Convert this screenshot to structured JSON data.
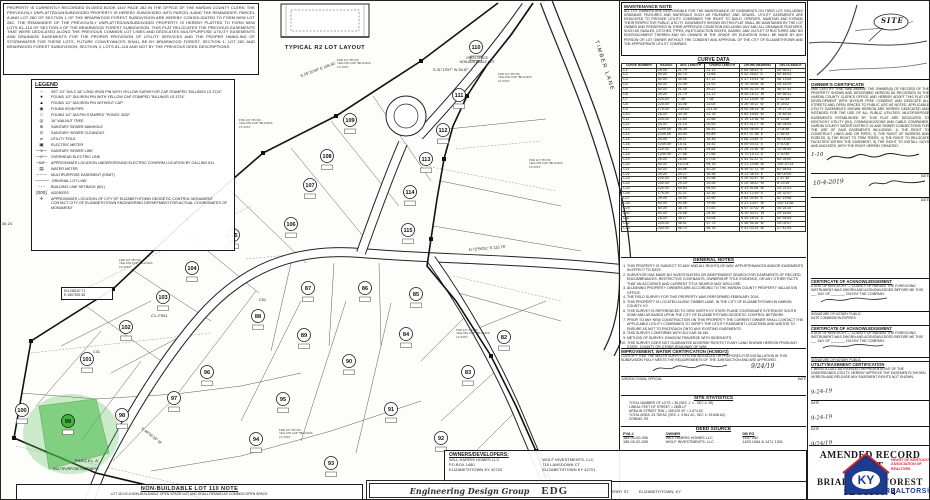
{
  "deed_note": {
    "text": "PROPERTY IS CURRENTLY RECORDED IN DEED BOOK 1447 PAGE 282 IN THE OFFICE OF THE HARDIN COUNTY CLERK. THE PREVIOUSLY UNPLATTED/UNSUBDIVIDED PROPERTY IS HEREBY SUBDIVIDED INTO PARCEL A AND THE REMAINDER. PARCEL A AND LOT 28C OF SECTION 1 OF THE BRIARWOOD FOREST SUBDIVISION ARE HEREBY CONSOLIDATED TO FORM NEW LOT 28C. THE REMAINDER OF THE PREVIOUSLY UNPLATTED/UNSUBDIVIDED PROPERTY IS HEREBY PLATTED TO FORM NEW LOTS 81–115 OF SECTION 4 OF THE BRIARWOOD FOREST SUBDIVISION. THIS PLAT RELOCATES THE PREVIOUS EASEMENTS THAT WERE DEDICATED ALONG THE PREVIOUS COMMON LOT LINES AND DEDICATES MULTIPURPOSE UTILITY EASEMENTS AND DRAINAGE EASEMENTS FOR THE PROPER PROVISION OF UTILITY SERVICES AND THE PROPER HANDLING OF STORMWATER FOR THESE LOTS. FUTURE CONVEYANCES SHALL BE BY BRIARWOOD FOREST, SECTION 1, LOT 28C AND BRIARWOOD FOREST SUBDIVISION, SECTION 4, LOTS 81–115 AND NOT BY THE PREVIOUS DEED DESCRIPTIONS."
  },
  "legend": {
    "title": "LEGEND",
    "items": [
      {
        "sym": "○",
        "label": "SET 1/2″ DIA X 18″ LONG IRON PIN WITH YELLOW SURVEYOR CAP STAMPED \"BILLINGS LS 3724\""
      },
      {
        "sym": "●",
        "label": "FOUND 1/2″ DIA IRON PIN WITH YELLOW CAP STAMPED \"BILLINGS LS 3724\""
      },
      {
        "sym": "▲",
        "label": "FOUND 1/2″ DIA IRON PIN WITHOUT CAP"
      },
      {
        "sym": "◉",
        "label": "FOUND IRON PIPE"
      },
      {
        "sym": "□",
        "label": "FOUND 1/2″ DIA PIN STAMPED \"PONCE 3032\""
      },
      {
        "sym": "◎",
        "label": "16″ WALNUT TREE"
      },
      {
        "sym": "⊜",
        "label": "SANITARY SEWER MANHOLE"
      },
      {
        "sym": "⊙",
        "label": "SANITARY SEWER CLEANOUT"
      },
      {
        "sym": "⌀",
        "label": "UTILITY POLE"
      },
      {
        "sym": "▣",
        "label": "ELECTRIC METER"
      },
      {
        "sym": "—s—",
        "label": "SANITARY SEWER LINE"
      },
      {
        "sym": "—e—",
        "label": "OVERHEAD ELECTRIC LINE"
      },
      {
        "sym": "–ue–",
        "label": "APPROXIMATE LOCATION UNDERGROUND ELECTRIC CONFIRM LOCATION BY CALLING 811"
      },
      {
        "sym": "▤",
        "label": "WATER METER"
      },
      {
        "sym": "– – –",
        "label": "MULTIPURPOSE EASEMENT (ESMT)"
      },
      {
        "sym": "———",
        "label": "ORIGINAL LOT LINE"
      },
      {
        "sym": "- - -",
        "label": "BUILDING LINE SETBACK (B/L)"
      },
      {
        "sym": "[000]",
        "label": "ADDRESS"
      },
      {
        "sym": "✛",
        "label": "APPROXIMATE LOCATION OF CITY OF ELIZABETHTOWN GEODETIC CONTROL MONUMENT.  CONTACT CITY OF ELIZABETHTOWN ENGINEERING DEPARTMENT FOR ACTUAL COORDINATES OF MONUMENT"
      }
    ]
  },
  "typical_lot": {
    "caption": "TYPICAL R2 LOT LAYOUT"
  },
  "maintenance_note": {
    "title": "MAINTENANCE NOTE",
    "text": "ALL LOT OWNERS ARE RESPONSIBLE FOR THE MAINTENANCE OF EASEMENTS ON THEIR LOT, INCLUDING DRAINAGE FEATURES AND MATERIALS SUCH AS PAVEMENT AND GRAVEL. UTILITY EASEMENTS ARE DEDICATED TO PROVIDE UTILITY COMPANIES THE RIGHT TO BUILD, OPERATE, MAINTAIN AND EXPAND THEIR RESPECTIVE PUBLIC UTILITY. EASEMENTS SHOWN ON THIS PLAT SHALL BE MAINTAINED BY THE LOT OWNER AND PRESERVED IN THEIR APPROVED CONDITION INCLUDING ANY AND ALL DRAINAGE FEATURES, SUCH AS SWALES, DITCHES, PIPES, INLET/JUNCTION BOXES, BASINS, AND OUTLET STRUCTURES AND NO ENCROACHMENT THEREIN AND NO CHANGE IN THE GRADE OR ELEVATION SHALL BE MADE BY ANY PERSON OR LOT OWNER WITHOUT THE CONSENT AND APPROVAL OF THE CITY OF ELIZABETHTOWN AND THE APPROPRIATE UTILITY COMPANY."
  },
  "curve_table": {
    "title": "CURVE DATA",
    "headers": [
      "CURVE NUMBER",
      "RADIUS",
      "ARC LENGTH",
      "CHORD LENGTH",
      "CHORD BEARING",
      "DELTA ANGLE"
    ],
    "rows": [
      [
        "C1",
        "25.00'",
        "21.79'",
        "21.11'",
        "S 85°58'43\" E",
        "49°56'41\""
      ],
      [
        "C2",
        "50.00'",
        "82.70'",
        "73.65'",
        "S 42°26'52\" E",
        "94°46'03\""
      ],
      [
        "C3",
        "50.00'",
        "49.06'",
        "47.11'",
        "S 37°19'41\" W",
        "56°13'05\""
      ],
      [
        "C4",
        "50.00'",
        "22.09'",
        "21.91'",
        "S 78°05'28\" W",
        "25°18'29\""
      ],
      [
        "C5",
        "50.00'",
        "51.45'",
        "49.22'",
        "N 59°42'25\" W",
        "58°57'44\""
      ],
      [
        "C6",
        "25.00'",
        "21.79'",
        "21.11'",
        "N 55°16'12\" W",
        "49°56'41\""
      ],
      [
        "C7",
        "225.00'",
        "7.38'",
        "7.38'",
        "S 31°14'05\" W",
        "1°52'45\""
      ],
      [
        "C8",
        "225.00'",
        "33.06'",
        "33.03'",
        "S 26°05'11\" W",
        "8°25'02\""
      ],
      [
        "C9",
        "175.00'",
        "239.63'",
        "221.30'",
        "N 60°06'14\" W",
        "78°27'13\""
      ],
      [
        "C10",
        "25.00'",
        "34.39'",
        "31.76'",
        "S 60°16'55\" W",
        "78°48'34\""
      ],
      [
        "C11",
        "225.00'",
        "12.69'",
        "12.68'",
        "S 19°14'18\" W",
        "3°13'46\""
      ],
      [
        "C12",
        "25.00'",
        "21.15'",
        "20.53'",
        "S 41°51'27\" W",
        "48°28'05\""
      ],
      [
        "C13",
        "1049.59'",
        "56.44'",
        "56.43'",
        "N 64°06'55\" E",
        "3°04'48\""
      ],
      [
        "C14",
        "1049.59'",
        "53.90'",
        "53.89'",
        "N 67°07'36\" E",
        "2°56'34\""
      ],
      [
        "C15",
        "25.00'",
        "39.27'",
        "35.36'",
        "S 66°23'45\" E",
        "90°00'00\""
      ],
      [
        "C16",
        "1049.59'",
        "15.41'",
        "15.41'",
        "N 69°04'31\" E",
        "0°50'28\""
      ],
      [
        "C17",
        "225.00'",
        "54.78'",
        "54.65'",
        "S 28°21'46\" W",
        "13°56'59\""
      ],
      [
        "C18",
        "1049.59'",
        "27.68'",
        "27.68'",
        "N 70°15'13\" E",
        "1°30'39\""
      ],
      [
        "C19",
        "25.00'",
        "28.55'",
        "27.05'",
        "S 53°41'22\" E",
        "65°26'00\""
      ],
      [
        "C20",
        "50.00'",
        "113.04'",
        "94.76'",
        "S 21°23'08\" W",
        "104°20'13\""
      ],
      [
        "C21",
        "50.00'",
        "54.96'",
        "52.26'",
        "N 49°37'11\" W",
        "62°58'04\""
      ],
      [
        "C22",
        "25.00'",
        "39.27'",
        "35.36'",
        "N 23°36'15\" E",
        "90°00'00\""
      ],
      [
        "C23",
        "225.00'",
        "10.98'",
        "10.98'",
        "S 20°02'47\" W",
        "2°47'30\""
      ],
      [
        "C24",
        "200.00'",
        "29.29'",
        "29.26'",
        "S 25°38'22\" W",
        "8°23'15\""
      ],
      [
        "C25",
        "225.00'",
        "95.64'",
        "94.93'",
        "S 33°51'06\" W",
        "24°21'31\""
      ],
      [
        "C26",
        "175.00'",
        "32.21'",
        "32.16'",
        "N 41°12'49\" E",
        "10°32'47\""
      ],
      [
        "C27",
        "25.00'",
        "35.92'",
        "32.90'",
        "S 64°09'30\" E",
        "82°19'48\""
      ],
      [
        "C28",
        "50.00'",
        "90.96'",
        "79.95'",
        "S 31°13'57\" W",
        "104°14'46\""
      ],
      [
        "C29",
        "50.00'",
        "38.75'",
        "37.81'",
        "N 67°37'02\" W",
        "44°24'10\""
      ],
      [
        "C30",
        "50.00'",
        "25.58'",
        "25.30'",
        "N 30°44'37\" W",
        "29°18'40\""
      ],
      [
        "C31",
        "25.00'",
        "36.17'",
        "33.08'",
        "N 55°28'31\" E",
        "82°54'04\""
      ],
      [
        "C32",
        "225.00'",
        "98.51'",
        "97.73'",
        "S 48°06'18\" W",
        "25°04'57\""
      ],
      [
        "C33",
        "200.00'",
        "96.70'",
        "95.76'",
        "S 41°02'33\" W",
        "27°42'05\""
      ]
    ]
  },
  "general_notes": {
    "title": "GENERAL NOTES",
    "items": [
      "THIS PROPERTY IS SUBJECT TO ANY AND ALL RIGHTS-OF-WAY, APPURTENANCES AND/OR EASEMENTS IN EFFECT TO DATE.",
      "SURVEYOR HAS MADE NO INVESTIGATION OR INDEPENDENT SEARCH FOR EASEMENTS OF RECORD, ENCUMBRANCES, RESTRICTIVE COVENANTS, OWNERSHIP TITLE EVIDENCE, OR ANY OTHER FACTS THAT AN ACCURATE AND CURRENT TITLE SEARCH MAY DISCLOSE.",
      "ADJOINING PROPERTY OWNERS ARE ACCORDING TO THE HARDIN COUNTY PROPERTY VALUATION OFFICE.",
      "THE FIELD SURVEY FOR THIS PROPERTY WAS PERFORMED FEBRUARY 2019.",
      "THIS PROPERTY IS LOCATED ALONG TIMBER LANE, IN THE CITY OF ELIZABETHTOWN IN HARDIN COUNTY, KY.",
      "THIS SURVEY IS REFERENCED TO GRID NORTH KY STATE PLANE COORDINATE SYSTEM BY SOUTH ZONE AND AS BASED UPON THE CITY OF ELIZABETHTOWN GEODETIC CONTROL NETWORK.",
      "PRIOR TO ANY NEW CONSTRUCTION ON THIS PROPERTY THE CURRENT OWNER SHALL CONTACT THE APPLICABLE UTILITY COMPANIES TO VERIFY THE UTILITY EASEMENT LOCATIONS AND WIDTHS TO ENSURE AS NOT TO ENCROACH ONTO ANY EXISTING EASEMENTS.",
      "THIS SURVEY CONFORMS WITH 201 KAR 18:150.",
      "METHOD OF SURVEY:  RANDOM TRAVERSE WITH SIDESHOTS.",
      "THIS SURVEY DOES NOT GUARANTEE ADVERSE RIGHTS TO ANY LAND SHOWN HEREON FROM ANY STATE, COUNTY OR OTHER ROADWAY OF WAY.",
      "THE RECORD SOURCE OF RIGHT OF WAY OF TIMBER LANE IS RECORD PLAT BRIARWOOD FOREST SECTION 2 IN PLAT CABINET 1 SHEET 4052 IN THE OFFICE OF THE HARDIN COUNTY CLERK."
    ]
  },
  "improvement_cert": {
    "title": "IMPROVEMENT, WATER CERTIFICATION (HCWD#2)",
    "text": "I CERTIFY THAT THE WATER SUPPLY SYSTEM INSTALLED OR PROPOSED FOR INSTALLATION IN THIS SUBDIVISION FULLY MEETS THE REQUIREMENTS OF THE JURISDICTION AND ARE APPROVED.",
    "official_label": "JURISDICTIONAL OFFICIAL",
    "date_label": "DATE",
    "date": "9/24/19"
  },
  "site_statistics": {
    "title": "SITE STATISTICS",
    "lines": [
      "TOTAL NUMBER OF LOTS = 36 (SEC 1: 1 , SEC 4: 35)",
      "LINEAL FEET OF STREET = 2655 LF",
      "AREA IN STREET R/W = 155,675 SF = 3.574 AC",
      "TOTAL AREA: 23.789 AC (SEC 1: 3.941 AC, SEC 4: 19.848 AC)",
      "ZONING:  R2"
    ]
  },
  "deed_source": {
    "title": "DEED SOURCE",
    "headers": [
      "PVA #",
      "OWNER",
      "DB   PG"
    ],
    "rows": [
      [
        "185-00-00-036",
        "WILL HARRIS HOMES LLC",
        "1447   282"
      ],
      [
        "185-00-02-039",
        "WOLF INVESTMENTS, LLC",
        "1453  1064 & 1471  1331"
      ]
    ]
  },
  "owners": {
    "title": "OWNERS/DEVELOPERS:",
    "col1": [
      "WILL HARRIS HOMES LLC",
      "PO BOX 1480",
      "ELIZABETHTOWN KY 42702"
    ],
    "col2": [
      "WOLF INVESTMENTS, LLC",
      "710 LANSDOWN CT",
      "ELIZABETHTOWN KY 42701"
    ]
  },
  "engineer": {
    "title": "ENGINEER/SURVEYOR:",
    "lines": [
      "ENGINEERING DESIGN GROUP, INC",
      "305 SOUTH MULBERRY ST",
      "ELIZABETHTOWN, KY"
    ]
  },
  "edg_stamp": {
    "line1": "Engineering Design Group",
    "line2": "EDG"
  },
  "non_buildable": {
    "title": "NON-BUILDABLE LOT 110 NOTE",
    "text": "LOT 110 IS A NON-BUILDABLE OPEN SPACE LOT AND SHALL REMAIN AS COMMON OPEN SPACE."
  },
  "owner_cert": {
    "title": "OWNER'S CERTIFICATE",
    "text": "I/WE CERTIFY THAT I/WE AM/ARE THE OWNER(S) OF RECORD OF THE PROPERTY SHOWN AND DESCRIBED HEREON AS RECORDED IN THE HARDIN COUNTY CLERK'S OFFICE AND HEREBY ADOPT THIS PLAT OF DEVELOPMENT WITH MY/OUR FREE CONSENT AND DEDICATE ALL STREETS AND OPEN SPACES TO PUBLIC USE AS NOTED. APPLICABLE UTILITY EASEMENTS SHOWN HEREON ARE HEREBY DEDICATED AND INTENDED FOR THE USE OF ALL PUBLIC UTILITIES. MULTIPURPOSE EASEMENTS ESTABLISHED BY THIS PLAT ARE DEDICATED TO KENTUCKY UTILITY (KU), COMMUNICATIONS AND CABLE COMPANIES, HARDIN COUNTY WATER DISTRICT #2 AND SEWER CONNECTIONS FOR THE USE OF SAID EASEMENTS INCLUDING: 1) THE RIGHT TO CONSTRUCT LINES AND OR PIPES, 2) THE RIGHT OF INGRESS AND EGRESS, 3) THE RIGHT TO TRIM TREES, 4) THE RIGHT TO RELOCATE FACILITIES WITHIN THE EASEMENT, 5) THE RIGHT TO INSTALL GUYS AND ANCHORS, WITH THE RIGHT HEREBY GRANTED.",
    "date1": "1-10",
    "date2": "10-4-2019",
    "date_label": "DATE"
  },
  "ack_certs": {
    "title": "CERTIFICATE OF ACKNOWLEDGEMENT",
    "body": "STATE OF KENTUCKY — COUNTY OF HARDIN. THE FOREGOING INSTRUMENT WAS SWORN AND ACKNOWLEDGED BEFORE ME THIS ___ DAY OF _______, 2019 BY THE COMPANY.",
    "notary_label": "SIGNATURE OF NOTARY PUBLIC",
    "expires_label": "DATE COMMISSION EXPIRES"
  },
  "utility_cert": {
    "title": "UTILITY/EASEMENT CERTIFICATION",
    "text": "I, BEING A DULY AUTHORIZED REPRESENTATIVE OF THE UNDERSIGNED UTILITY, HEREBY APPROVE THE EASEMENTS SHOWN HEREON AND RELEASE ANY EASEMENT RIGHTS NOT SHOWN.",
    "date_label": "DATE",
    "dates": [
      "9-24-19",
      "9-24-19",
      "9/24/19",
      "12-9-2019"
    ]
  },
  "title_block": {
    "line1": "AMENDED RECORD PLAT",
    "line2": "OF",
    "line3": "BRIARWOOD FOREST",
    "line4": "SECTION 4"
  },
  "ky_logo": {
    "text": "KY",
    "tagline1": "HEART OF KENTUCKY",
    "tagline2": "ASSOCIATION OF",
    "tagline3": "REALTORS",
    "realtors": "REALTORS®",
    "blue": "#1d3c8f",
    "red": "#d22730"
  },
  "vicinity": {
    "site_label": "SITE"
  },
  "plat": {
    "road_label": "TIMBER LANE",
    "coord_line1": "N:2138167.71",
    "coord_line2": "E:1507592.36",
    "parcel_label": "PARCEL A",
    "easement_label": "MULTIPURPOSE EASEMENT",
    "open_space_line1": "OPEN SPACE",
    "open_space_line2": "NON-BUILDABLE LOT",
    "c_label": "C1–F901",
    "edge_dim": "35.24",
    "pin_note": "FND 1/2″ PIN W/ YELLOW CAP \"BILLINGS LS 3724\"",
    "pin_note_positions": [
      [
        336,
        58
      ],
      [
        238,
        118
      ],
      [
        118,
        258
      ],
      [
        497,
        72
      ],
      [
        528,
        158
      ],
      [
        455,
        328
      ],
      [
        278,
        428
      ],
      [
        155,
        198
      ]
    ],
    "bearings": [
      {
        "t": "S 25°10'30\" E  155.40'",
        "x": 300,
        "y": 76,
        "r": -20
      },
      {
        "t": "S 31°13'57\" W  30.87'",
        "x": 432,
        "y": 70,
        "r": 0
      },
      {
        "t": "N 72°56'51\" E  115.78'",
        "x": 468,
        "y": 250,
        "r": -5
      },
      {
        "t": "S 48°06'18\" W",
        "x": 140,
        "y": 428,
        "r": 38
      },
      {
        "t": "C31",
        "x": 92,
        "y": 352,
        "r": 0
      },
      {
        "t": "C51",
        "x": 258,
        "y": 300,
        "r": 0
      }
    ],
    "green_lot": "99",
    "lots": [
      {
        "n": "82",
        "x": 503,
        "y": 336
      },
      {
        "n": "83",
        "x": 467,
        "y": 371
      },
      {
        "n": "84",
        "x": 405,
        "y": 333
      },
      {
        "n": "85",
        "x": 415,
        "y": 293
      },
      {
        "n": "86",
        "x": 364,
        "y": 287
      },
      {
        "n": "87",
        "x": 307,
        "y": 287
      },
      {
        "n": "88",
        "x": 257,
        "y": 315
      },
      {
        "n": "89",
        "x": 303,
        "y": 334
      },
      {
        "n": "90",
        "x": 348,
        "y": 360
      },
      {
        "n": "91",
        "x": 390,
        "y": 408
      },
      {
        "n": "92",
        "x": 440,
        "y": 437
      },
      {
        "n": "93",
        "x": 330,
        "y": 462
      },
      {
        "n": "94",
        "x": 255,
        "y": 438
      },
      {
        "n": "95",
        "x": 282,
        "y": 398
      },
      {
        "n": "96",
        "x": 206,
        "y": 371
      },
      {
        "n": "97",
        "x": 173,
        "y": 397
      },
      {
        "n": "98",
        "x": 121,
        "y": 414
      },
      {
        "n": "99",
        "x": 67,
        "y": 420
      },
      {
        "n": "100",
        "x": 21,
        "y": 409
      },
      {
        "n": "101",
        "x": 86,
        "y": 358
      },
      {
        "n": "102",
        "x": 125,
        "y": 326
      },
      {
        "n": "103",
        "x": 162,
        "y": 296
      },
      {
        "n": "104",
        "x": 191,
        "y": 267
      },
      {
        "n": "105",
        "x": 232,
        "y": 234
      },
      {
        "n": "106",
        "x": 290,
        "y": 223
      },
      {
        "n": "107",
        "x": 309,
        "y": 184
      },
      {
        "n": "108",
        "x": 326,
        "y": 155
      },
      {
        "n": "109",
        "x": 349,
        "y": 119
      },
      {
        "n": "110",
        "x": 475,
        "y": 46
      },
      {
        "n": "111",
        "x": 458,
        "y": 94
      },
      {
        "n": "112",
        "x": 442,
        "y": 129
      },
      {
        "n": "113",
        "x": 425,
        "y": 158
      },
      {
        "n": "114",
        "x": 409,
        "y": 191
      },
      {
        "n": "115",
        "x": 407,
        "y": 229
      }
    ]
  }
}
